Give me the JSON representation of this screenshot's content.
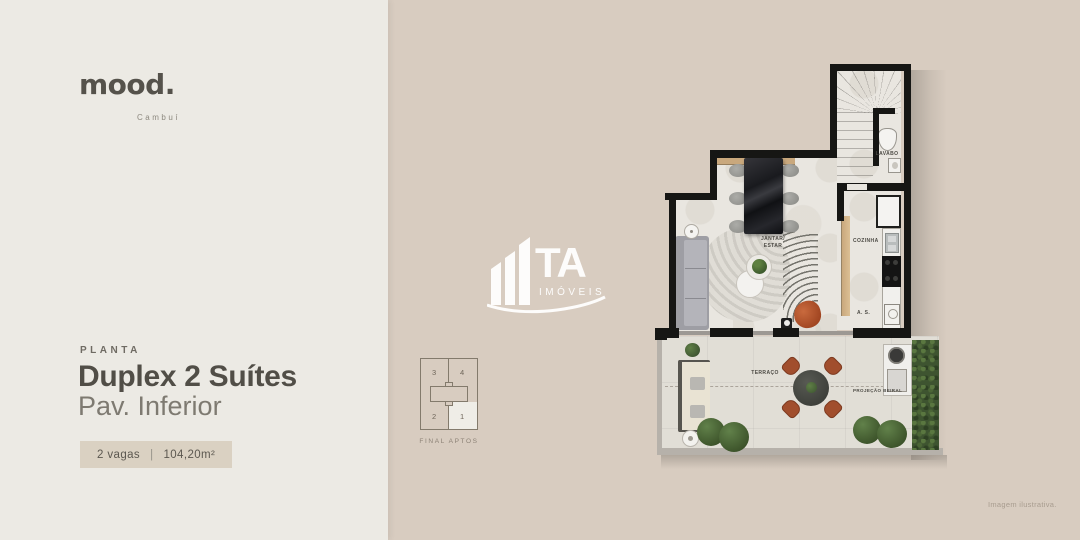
{
  "brand": {
    "logo": "mood.",
    "city": "Cambuí"
  },
  "left_panel": {
    "eyebrow": "PLANTA",
    "title": "Duplex 2 Suítes",
    "subtitle": "Pav. Inferior",
    "badge": {
      "parking": "2 vagas",
      "separator": "|",
      "area": "104,20m²"
    }
  },
  "keyplan": {
    "caption": "FINAL APTOS",
    "units": {
      "top_left": "3",
      "top_right": "4",
      "bottom_left": "2",
      "bottom_right": "1"
    }
  },
  "watermark": {
    "initials": "TA",
    "word": "IMÓVEIS"
  },
  "floorplan": {
    "rooms": {
      "dining_line1": "JANTAR/",
      "dining_line2": "ESTAR",
      "kitchen": "COZINHA",
      "service": "A. S.",
      "lavabo": "LAVABO",
      "terrace": "TERRAÇO",
      "projection": "PROJEÇÃO BEIRAL"
    }
  },
  "footer": {
    "disclaimer": "Imagem ilustrativa."
  },
  "colors": {
    "left_bg": "#ECEAE4",
    "right_bg": "#D8CCC0",
    "badge_bg": "#DAD1C2",
    "wall": "#161614",
    "wood": "#C9A87D",
    "terrace_chair": "#A14E2D",
    "hedge": "#3E5430"
  }
}
